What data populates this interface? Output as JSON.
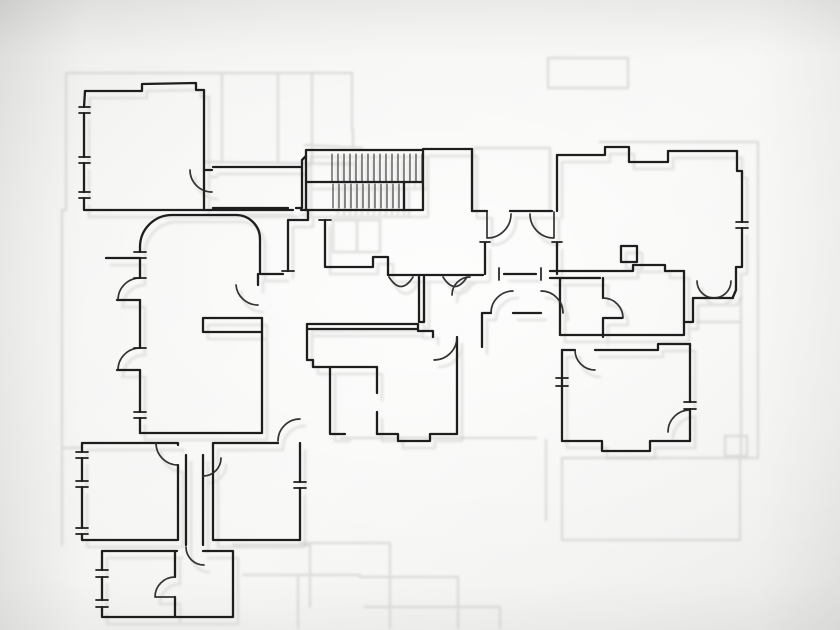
{
  "meta": {
    "title": "Hand-traced floor plan",
    "description": "Black ink hand-traced architectural floor plan over a faint grey blueprint underlay on tracing paper",
    "canvas_width": 840,
    "canvas_height": 630
  },
  "palette": {
    "paper_center": "#f6f6f4",
    "paper_edge": "#e8e8e6",
    "ink": "#1e1e1e",
    "ink_soft": "#2a2a2a",
    "ghost": "#cbcbc9"
  },
  "drawing": {
    "viewbox": "0 0 840 630",
    "layers": [
      {
        "id": "ghost-underlay-extra",
        "stroke": "ghost",
        "width": 2.4,
        "opacity": 0.6,
        "blur": true,
        "paths": [
          "M66,73 L205,73 M66,73 L66,210 M62,210 L66,210 M62,210 L62,448 M62,448 L82,448 M62,448 L62,545",
          "M205,73 L352,73 M222,73 L222,162 M278,73 L278,162 M312,73 L312,162 M352,73 L352,130 M205,162 L352,164 M353,130 L353,148 M305,145 L362,148",
          "M473,148 L550,148 M550,148 L550,210 M473,148 L473,210",
          "M548,58 L628,58 M548,58 L548,88 M628,58 L628,88 M548,88 L628,88",
          "M333,220 L380,220 L380,252 L333,252 L333,220 M357,220 L357,252",
          "M600,142 L758,142 M758,142 L758,458 M758,458 L562,458",
          "M741,298 L741,455 M697,322 L741,322 M725,436 L747,436 L747,456 L725,456 L725,436",
          "M740,458 L740,540 M562,458 L562,540 M562,540 L740,540",
          "M341,438 L536,438 M546,440 L546,520",
          "M300,543 L390,543 M390,543 L390,628 M233,545 L310,545 M310,545 L310,607",
          "M243,575 L360,575 M298,577 L298,628 M360,577 L458,577 M458,577 L458,628 M365,607 L500,607 M500,607 L500,628"
        ]
      },
      {
        "id": "ghost-underlay-trace",
        "stroke": "ghost",
        "width": 2.6,
        "opacity": 0.5,
        "blur": true,
        "transform": "translate(5,7)",
        "clone_of": [
          "ink-walls",
          "door-arcs",
          "stair-hatch"
        ],
        "paths": []
      },
      {
        "id": "stair-hatch",
        "stroke": "ink_soft",
        "width": 1.1,
        "opacity": 0.95,
        "paths": [
          "M332,154 L332,181 M338,154 L338,181 M344,154 L344,181 M350,154 L350,181 M356,154 L356,181 M362,154 L362,181 M368,154 L368,181 M374,154 L374,181 M380,154 L380,181 M386,154 L386,181 M392,154 L392,181 M398,154 L398,181 M404,154 L404,181 M410,154 L410,181 M416,154 L416,181 M422,154 L422,181",
          "M333,184 L333,208 M339,184 L339,208 M345,184 L345,208 M351,184 L351,208 M357,184 L357,208 M363,184 L363,208 M369,184 L369,208 M375,184 L375,208 M381,184 L381,208 M387,184 L387,208 M393,184 L393,208 M399,184 L399,208"
        ]
      },
      {
        "id": "ink-walls",
        "stroke": "ink",
        "width": 2.3,
        "opacity": 1,
        "paths": [
          "M85,91 L142,91 L142,84 L196,83 L196,90 L204,90",
          "M204,90 L204,210",
          "M204,210 L84,210 M84,210 L84,198 M84,192 L84,163 M84,157 L84,113 M84,107 L85,91",
          "M204,170 L212,170 M213,167 L302,167 L302,160 L306,156",
          "M213,208 L288,208 M296,208 L302,208 M302,167 L302,208",
          "M204,210 L293,210 M301,210 L306,210",
          "M306,150 L423,150 L423,210 L306,210 L306,150",
          "M306,182 L423,182 M404,182 L404,210",
          "M423,149 L472,149 M472,149 L472,211",
          "M308,210 L308,220 L288,220 M288,220 L288,271",
          "M325,220 L325,267 L373,267 M373,267 L373,257 L388,257 M388,257 L388,275",
          "M260,239 L260,274 M260,274 L283,274 M258,274 L258,285",
          "M388,275 L483,275 M419,277 L419,322 M424,277 L424,322 M419,322 L424,322",
          "M307,324 L418,324 M307,329 L418,329 M307,324 L307,329 M418,324 L418,331 L433,331 L433,337",
          "M307,329 L307,360 L313,360 L313,367 L330,367",
          "M330,367 L330,434 L345,434 M330,367 L377,367",
          "M377,367 L377,393 M377,412 L377,434",
          "M377,434 L398,434 L398,441 L430,441 L430,434 L457,434",
          "M457,337 L457,434",
          "M482,313 L491,313 M513,313 L541,313 M482,313 L482,347",
          "M472,211 L487,211 M510,211 L552,211",
          "M485,243 L485,274 M557,243 L557,274 M504,274 L536,274",
          "M557,155 L557,211",
          "M557,155 L605,155 L605,147 L629,147 M629,147 L629,162 L668,162 M668,162 L668,151 L737,151",
          "M737,151 L737,171 L742,171 L742,222 M742,228 L742,267 L736,267 L736,290 L733,297",
          "M621,246 L637,246 L637,262 L621,262 L621,246",
          "M550,271 L633,271 L633,265 L665,265 L665,271 L684,271",
          "M550,278 L600,278 M560,278 L560,335",
          "M603,278 L603,298 M603,318 L603,337 M603,318 L622,318",
          "M560,335 L684,335 M684,271 L684,335",
          "M693,298 L733,298 M693,298 L693,322 M684,322 L693,322",
          "M562,350 L575,350 M595,350 L658,350 M658,350 L658,344 L690,344",
          "M562,350 L562,441 M562,441 L602,441 L602,451 L650,451 L650,441 L690,441",
          "M690,344 L690,402 M690,409 L690,441",
          "M140,247 A32,32 0 0 1 172,215 M172,215 L236,215 M236,215 A24,24 0 0 1 260,239",
          "M140,247 L140,252 M140,258 L140,278 M140,300 L140,348 M140,370 L140,412 M140,418 L140,433",
          "M117,300 L140,300 M117,370 L140,370",
          "M203,318 L262,318 M203,332 L262,332 M203,318 L203,332",
          "M262,318 L262,332 M262,332 L262,433 M140,433 L262,433",
          "M106,258 L140,258",
          "M82,443 L178,443 M82,443 L82,452 M82,458 L82,481 M82,487 L82,528 M82,534 L82,540 M82,540 L178,540 M178,443 L178,445 M178,465 L178,540",
          "M186,455 L186,545 M203,455 L203,545",
          "M213,443 L278,443 M213,443 L213,540 M213,540 L300,540 M300,443 L300,482 M300,488 L300,540",
          "M102,551 L177,551 M203,551 L233,551 M102,551 L102,570 M102,577 L102,600 M102,607 L102,617 M102,617 L233,617 M233,551 L233,617",
          "M175,551 L175,577 M175,597 L175,617"
        ]
      },
      {
        "id": "door-arcs",
        "stroke": "ink_soft",
        "width": 1.7,
        "opacity": 0.95,
        "paths": [
          "M190,170 A22,22 0 0 0 212,192",
          "M140,278 A22,22 0 0 0 118,300",
          "M140,348 A22,22 0 0 0 118,370",
          "M258,305 A22,22 0 0 1 236,285",
          "M389,277 Q401,296 413,277",
          "M443,277 Q455,296 467,277",
          "M457,337 A23,23 0 0 1 434,360",
          "M487,212 L487,238 M487,238 A24,24 0 0 0 511,214",
          "M554,212 L554,238 M554,238 A24,24 0 0 1 530,214",
          "M491,313 A22,22 0 0 1 513,291",
          "M541,291 A22,22 0 0 1 563,313",
          "M470,277 A18,18 0 0 0 452,295",
          "M603,298 A20,20 0 0 1 623,318",
          "M575,350 A20,20 0 0 0 595,370",
          "M697,281 A17,17 0 0 0 714,298 M731,281 A17,17 0 0 1 714,298",
          "M690,410 A22,22 0 0 0 668,432",
          "M178,465 A22,22 0 0 1 156,443",
          "M203,476 A18,18 0 0 0 221,458",
          "M278,441 A22,22 0 0 1 300,419",
          "M175,577 A20,20 0 0 0 155,597 M155,597 L175,597",
          "M186,547 A18,18 0 0 0 204,565"
        ]
      },
      {
        "id": "window-ticks",
        "stroke": "ink",
        "width": 1.7,
        "opacity": 1,
        "paths": [
          "M79,107 L90,107 M79,113 L90,113 M79,157 L90,157 M79,163 L90,163 M79,192 L90,192 M79,198 L90,198",
          "M134,252 L146,252 M134,258 L146,258 M134,278 L146,278 M134,348 L146,348 M134,412 L146,412 M134,418 L146,418",
          "M736,222 L748,222 M736,228 L748,228",
          "M556,378 L568,378 M556,386 L568,386",
          "M684,402 L696,402 M684,409 L696,409",
          "M76,452 L88,452 M76,458 L88,458 M76,481 L88,481 M76,487 L88,487 M76,528 L88,528 M76,534 L88,534",
          "M294,482 L306,482 M294,488 L306,488",
          "M96,570 L108,570 M96,577 L108,577 M96,600 L108,600 M96,607 L108,607",
          "M282,271 L294,271 M319,220 L331,220",
          "M499,268 L499,280 M541,268 L541,280 M480,242 L490,242 M552,242 L562,242"
        ]
      }
    ]
  }
}
